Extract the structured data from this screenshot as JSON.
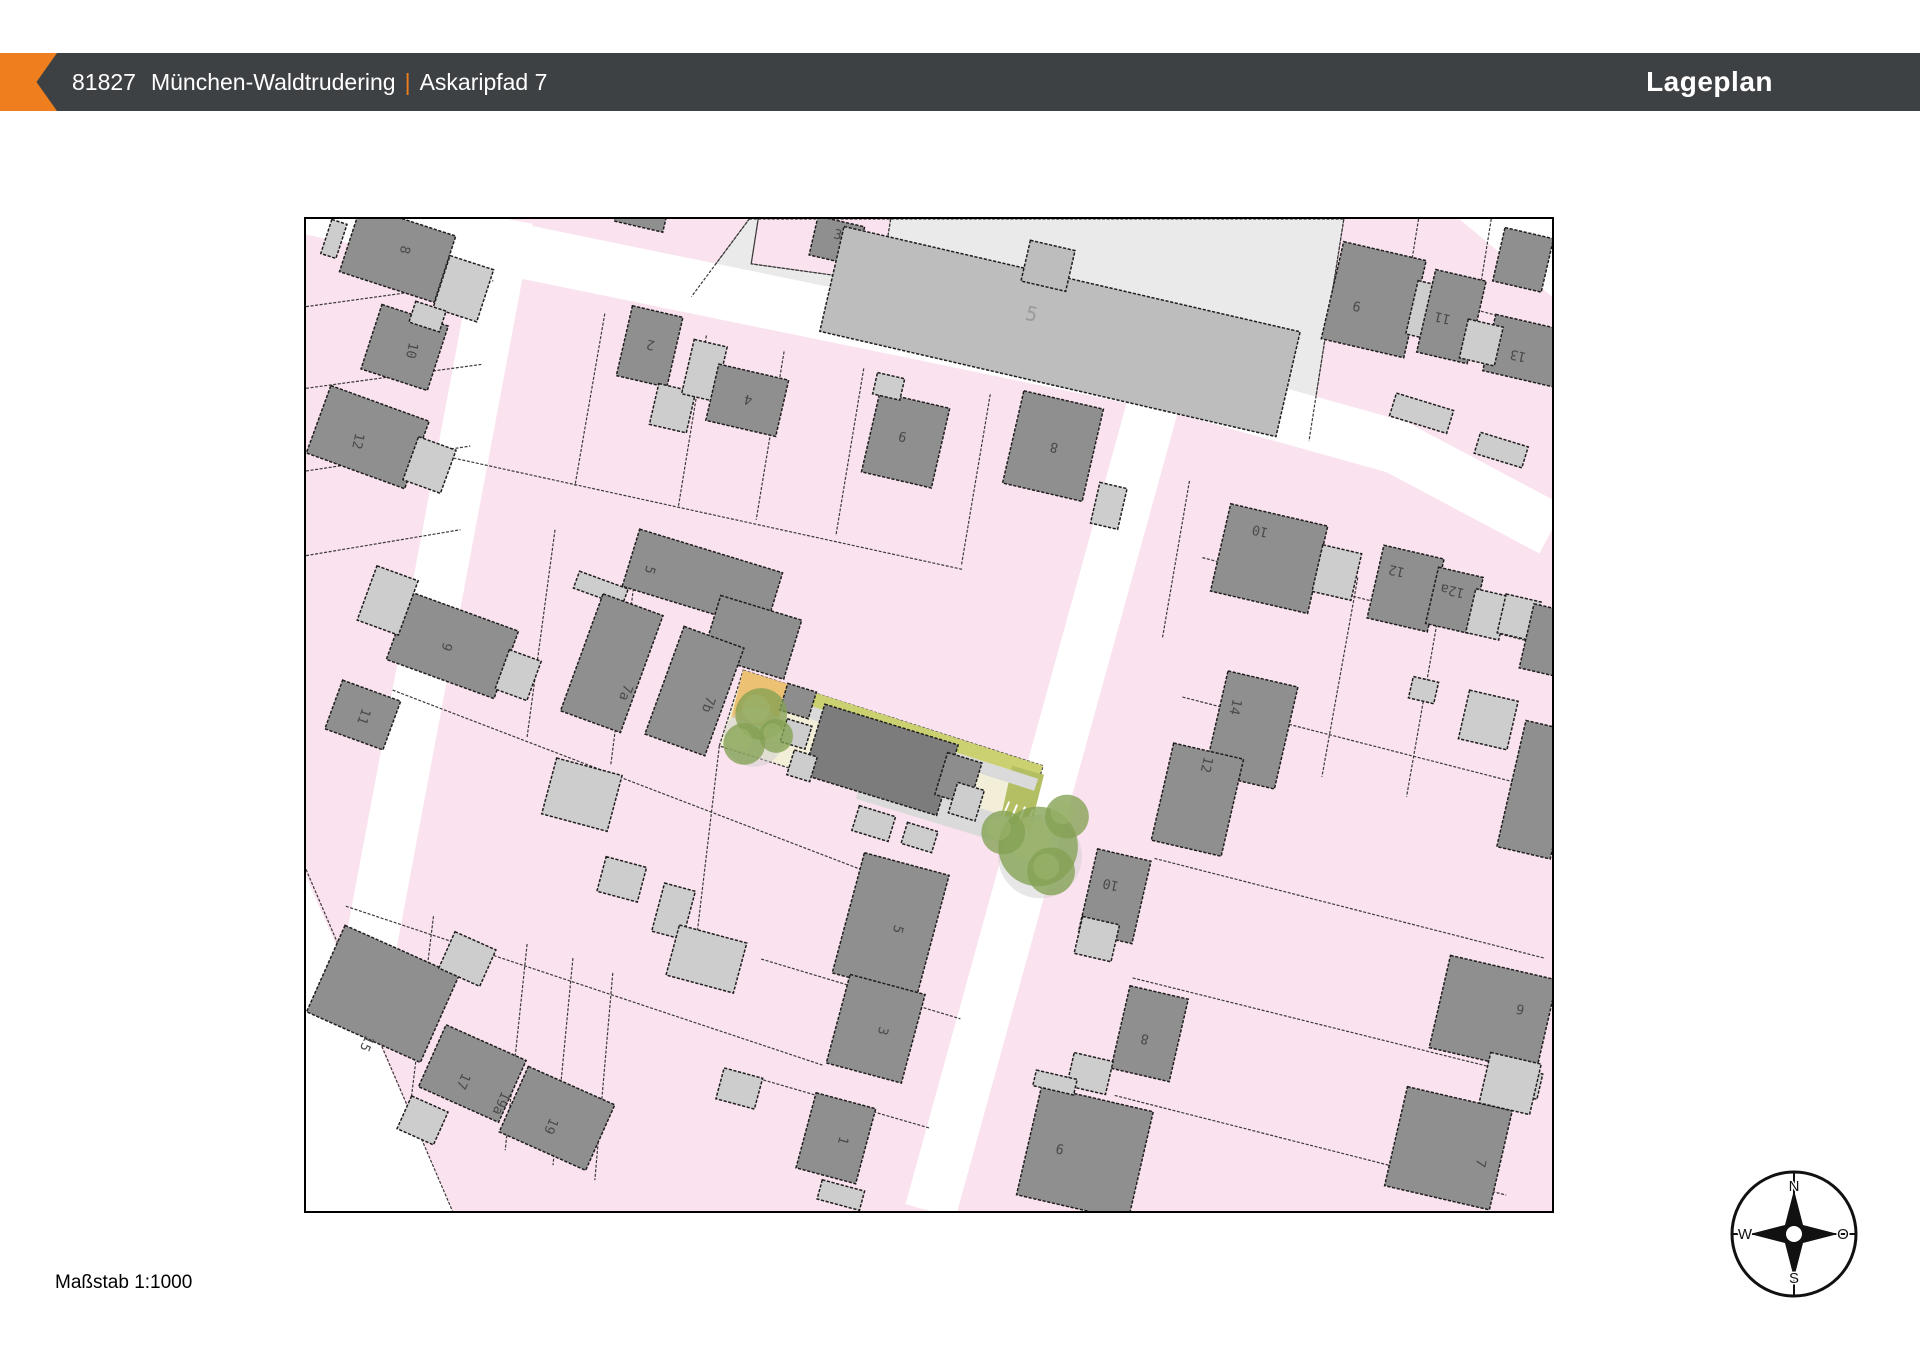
{
  "header": {
    "postal_code": "81827",
    "city": "München-Waldtrudering",
    "separator": "|",
    "street": "Askaripfad 7",
    "title": "Lageplan",
    "bar_color": "#3e4144",
    "accent_color": "#ee7e1e"
  },
  "footer": {
    "scale_label": "Maßstab 1:1000"
  },
  "compass": {
    "north": "N",
    "east": "O",
    "south": "S",
    "west": "W"
  },
  "map": {
    "colors": {
      "pink": "#fae2ee",
      "line": "#3a3a3a",
      "street": "#ffffff",
      "dark": "#8f8f8f",
      "light": "#cdcdcd",
      "school_fill": "#bdbdbd",
      "school_parcel": "#eaeaea",
      "plot_dark": "#7c7c7c",
      "plot_mid": "#8d8d8d",
      "outline": "#1e1e1e",
      "cream": "#f3eed8",
      "orange_patch": "#ecc173",
      "green_strip": "#cbd170",
      "olive": "#b4bf63",
      "path_gray": "#dadada",
      "tree": "#84a253",
      "tree_light": "#9db46c",
      "tree_shadow": "#cfcfcf",
      "number": "#4a4a4a",
      "school_number": "#9a9a9a"
    },
    "streets": [
      {
        "pts": "-15,-15 600,111 880,169 1095,229 1251,312",
        "w": 54
      },
      {
        "pts": "202,0 15,996",
        "w": 52
      },
      {
        "pts": "855,170 627,996",
        "w": 52
      }
    ],
    "white_patches": [
      "1158,0 1251,0 1251,78",
      "0,660 147,996 0,996"
    ],
    "school": {
      "outer": "445,0 1042,0 1007,223 387,78",
      "notch": "454,0 587,0 577,63 447,45"
    },
    "parcel_lines": [
      [
        445,
        0,
        387,
        78
      ],
      [
        1042,
        0,
        1007,
        223
      ],
      [
        454,
        0,
        447,
        45
      ],
      [
        587,
        0,
        577,
        63
      ],
      [
        577,
        63,
        447,
        45
      ],
      [
        1042,
        55,
        1251,
        112
      ],
      [
        1117,
        0,
        1098,
        118
      ],
      [
        1190,
        0,
        1172,
        112
      ],
      [
        300,
        95,
        270,
        268
      ],
      [
        402,
        117,
        374,
        288
      ],
      [
        480,
        133,
        452,
        302
      ],
      [
        560,
        150,
        532,
        318
      ],
      [
        687,
        176,
        658,
        348
      ],
      [
        148,
        240,
        660,
        352
      ],
      [
        0,
        88,
        188,
        62
      ],
      [
        0,
        170,
        176,
        146
      ],
      [
        0,
        253,
        165,
        228
      ],
      [
        0,
        338,
        155,
        312
      ],
      [
        87,
        473,
        557,
        653
      ],
      [
        40,
        690,
        520,
        850
      ],
      [
        250,
        312,
        222,
        520
      ],
      [
        334,
        330,
        306,
        548
      ],
      [
        455,
        352,
        443,
        445
      ],
      [
        128,
        700,
        103,
        905
      ],
      [
        222,
        728,
        200,
        935
      ],
      [
        268,
        742,
        248,
        950
      ],
      [
        308,
        757,
        290,
        965
      ],
      [
        457,
        743,
        657,
        803
      ],
      [
        437,
        858,
        627,
        913
      ],
      [
        415,
        529,
        390,
        740
      ],
      [
        900,
        340,
        1251,
        430
      ],
      [
        880,
        480,
        1251,
        575
      ],
      [
        852,
        642,
        1243,
        742
      ],
      [
        830,
        762,
        1232,
        862
      ],
      [
        812,
        880,
        1205,
        980
      ],
      [
        1056,
        360,
        1020,
        560
      ],
      [
        1140,
        380,
        1105,
        580
      ],
      [
        887,
        263,
        860,
        420
      ],
      [
        0,
        653,
        147,
        996
      ]
    ],
    "highlight": {
      "plot": "439,453 740,549 718,625 415,529",
      "orange": "439,453 484,467 471,514 427,500",
      "green_strip": "484,467 740,549 735,562 479,480",
      "olive": "709,549 741,558 727,613 697,604",
      "paths": [
        "479,480 735,562 731,574 475,492",
        "560,556 708,601 700,627 552,582"
      ],
      "ticks": [
        [
          706,
          585,
          700,
          599
        ],
        [
          714,
          588,
          708,
          602
        ],
        [
          722,
          590,
          716,
          604
        ],
        [
          730,
          593,
          724,
          607
        ]
      ],
      "tree_shadows": [
        [
          450,
          520,
          30
        ],
        [
          737,
          640,
          42
        ]
      ],
      "trees": [
        [
          457,
          497,
          26
        ],
        [
          440,
          527,
          21
        ],
        [
          472,
          519,
          17
        ],
        [
          735,
          630,
          40
        ],
        [
          700,
          616,
          22
        ],
        [
          764,
          600,
          22
        ],
        [
          748,
          655,
          24
        ]
      ]
    },
    "buildings": [
      [
        92,
        35,
        100,
        70,
        18,
        "d"
      ],
      [
        158,
        70,
        46,
        55,
        18,
        "l"
      ],
      [
        28,
        20,
        16,
        36,
        18,
        "l"
      ],
      [
        99,
        129,
        70,
        68,
        18,
        "d"
      ],
      [
        122,
        98,
        32,
        22,
        18,
        "l"
      ],
      [
        62,
        219,
        105,
        72,
        20,
        "d"
      ],
      [
        124,
        247,
        40,
        46,
        20,
        "l"
      ],
      [
        337,
        -6,
        50,
        28,
        13,
        "d"
      ],
      [
        345,
        128,
        52,
        72,
        13,
        "d"
      ],
      [
        368,
        190,
        38,
        42,
        13,
        "l"
      ],
      [
        400,
        152,
        34,
        56,
        13,
        "l"
      ],
      [
        443,
        182,
        72,
        58,
        13,
        "d"
      ],
      [
        533,
        22,
        48,
        40,
        13,
        "d"
      ],
      [
        602,
        222,
        72,
        82,
        13,
        "d"
      ],
      [
        585,
        168,
        28,
        22,
        13,
        "l"
      ],
      [
        750,
        228,
        82,
        95,
        13,
        "d"
      ],
      [
        806,
        288,
        28,
        42,
        13,
        "l"
      ],
      [
        757,
        113,
        470,
        108,
        13,
        "sc"
      ],
      [
        745,
        47,
        46,
        42,
        13,
        "sc"
      ],
      [
        1072,
        81,
        85,
        100,
        13,
        "d"
      ],
      [
        1125,
        92,
        30,
        55,
        13,
        "l"
      ],
      [
        1150,
        98,
        52,
        85,
        13,
        "d"
      ],
      [
        1227,
        133,
        80,
        58,
        13,
        "d"
      ],
      [
        1222,
        41,
        50,
        55,
        13,
        "d"
      ],
      [
        1180,
        124,
        36,
        40,
        13,
        "l"
      ],
      [
        1120,
        195,
        60,
        24,
        17,
        "l"
      ],
      [
        1200,
        232,
        50,
        22,
        17,
        "l"
      ],
      [
        398,
        362,
        150,
        60,
        17,
        "d"
      ],
      [
        448,
        420,
        85,
        62,
        17,
        "d"
      ],
      [
        296,
        371,
        52,
        18,
        20,
        "l"
      ],
      [
        307,
        446,
        64,
        125,
        20,
        "d"
      ],
      [
        390,
        474,
        64,
        115,
        20,
        "d"
      ],
      [
        147,
        428,
        115,
        72,
        20,
        "d"
      ],
      [
        213,
        458,
        34,
        42,
        20,
        "l"
      ],
      [
        82,
        383,
        44,
        58,
        20,
        "l"
      ],
      [
        57,
        498,
        62,
        52,
        20,
        "d"
      ],
      [
        77,
        778,
        125,
        95,
        24,
        "d"
      ],
      [
        162,
        743,
        45,
        40,
        24,
        "l"
      ],
      [
        167,
        858,
        88,
        68,
        24,
        "d"
      ],
      [
        252,
        903,
        95,
        72,
        24,
        "d"
      ],
      [
        117,
        905,
        40,
        36,
        24,
        "l"
      ],
      [
        277,
        578,
        68,
        58,
        15,
        "l"
      ],
      [
        317,
        663,
        42,
        36,
        15,
        "l"
      ],
      [
        369,
        695,
        32,
        50,
        15,
        "l"
      ],
      [
        587,
        708,
        88,
        125,
        15,
        "d"
      ],
      [
        402,
        743,
        70,
        52,
        15,
        "l"
      ],
      [
        572,
        813,
        78,
        92,
        15,
        "d"
      ],
      [
        532,
        923,
        62,
        78,
        15,
        "d"
      ],
      [
        435,
        873,
        40,
        32,
        15,
        "l"
      ],
      [
        537,
        980,
        44,
        20,
        15,
        "l"
      ],
      [
        967,
        341,
        100,
        90,
        13,
        "d"
      ],
      [
        1035,
        355,
        40,
        48,
        13,
        "l"
      ],
      [
        1104,
        371,
        62,
        75,
        13,
        "d"
      ],
      [
        1153,
        383,
        46,
        58,
        13,
        "d"
      ],
      [
        1186,
        397,
        34,
        45,
        13,
        "l"
      ],
      [
        1218,
        400,
        36,
        40,
        13,
        "l"
      ],
      [
        1245,
        423,
        40,
        66,
        13,
        "d"
      ],
      [
        949,
        513,
        72,
        105,
        13,
        "d"
      ],
      [
        895,
        583,
        72,
        100,
        13,
        "d"
      ],
      [
        1187,
        503,
        50,
        50,
        13,
        "l"
      ],
      [
        1122,
        473,
        26,
        22,
        13,
        "l"
      ],
      [
        1237,
        573,
        55,
        130,
        13,
        "d"
      ],
      [
        812,
        680,
        55,
        85,
        13,
        "d"
      ],
      [
        794,
        723,
        38,
        38,
        13,
        "l"
      ],
      [
        847,
        818,
        60,
        85,
        13,
        "d"
      ],
      [
        787,
        858,
        40,
        34,
        13,
        "l"
      ],
      [
        1192,
        798,
        110,
        95,
        13,
        "d"
      ],
      [
        1212,
        865,
        55,
        26,
        13,
        "l"
      ],
      [
        782,
        938,
        115,
        112,
        13,
        "d"
      ],
      [
        752,
        867,
        42,
        16,
        13,
        "l"
      ],
      [
        1147,
        933,
        108,
        102,
        13,
        "d"
      ],
      [
        1209,
        868,
        52,
        52,
        13,
        "l"
      ],
      [
        577,
        543,
        140,
        74,
        17,
        "pd"
      ],
      [
        655,
        562,
        36,
        44,
        17,
        "pm"
      ],
      [
        494,
        484,
        30,
        28,
        17,
        "pm"
      ],
      [
        492,
        517,
        26,
        24,
        17,
        "l"
      ],
      [
        498,
        549,
        24,
        26,
        17,
        "l"
      ],
      [
        570,
        607,
        38,
        26,
        17,
        "l"
      ],
      [
        616,
        621,
        32,
        22,
        17,
        "l"
      ],
      [
        663,
        585,
        28,
        32,
        17,
        "l"
      ]
    ],
    "house_numbers": [
      [
        "8",
        95,
        30,
        103
      ],
      [
        "10",
        102,
        131,
        103
      ],
      [
        "12",
        48,
        222,
        103
      ],
      [
        "2",
        347,
        122,
        193
      ],
      [
        "4",
        445,
        177,
        193
      ],
      [
        "3",
        533,
        20,
        13
      ],
      [
        "9",
        600,
        214,
        193
      ],
      [
        "8",
        752,
        225,
        193
      ],
      [
        "9",
        1056,
        83,
        193
      ],
      [
        "11",
        1142,
        95,
        193
      ],
      [
        "13",
        1218,
        133,
        193
      ],
      [
        "5",
        341,
        351,
        107
      ],
      [
        "7a",
        317,
        474,
        110
      ],
      [
        "7b",
        400,
        486,
        110
      ],
      [
        "9",
        137,
        428,
        110
      ],
      [
        "11",
        54,
        498,
        110
      ],
      [
        "15",
        57,
        826,
        114
      ],
      [
        "17",
        154,
        864,
        114
      ],
      [
        "19a",
        192,
        886,
        114
      ],
      [
        "19",
        242,
        909,
        114
      ],
      [
        "5",
        590,
        712,
        105
      ],
      [
        "3",
        575,
        814,
        105
      ],
      [
        "1",
        535,
        924,
        105
      ],
      [
        "10",
        959,
        309,
        193
      ],
      [
        "12",
        1096,
        349,
        193
      ],
      [
        "12a",
        1152,
        369,
        193
      ],
      [
        "14",
        929,
        489,
        103
      ],
      [
        "12",
        900,
        547,
        103
      ],
      [
        "10",
        809,
        664,
        193
      ],
      [
        "8",
        843,
        819,
        193
      ],
      [
        "6",
        1220,
        789,
        193
      ],
      [
        "9",
        758,
        929,
        193
      ],
      [
        "7",
        1175,
        947,
        103
      ]
    ],
    "school_label": {
      "t": "5",
      "x": 727,
      "y": 102,
      "r": 13
    }
  }
}
